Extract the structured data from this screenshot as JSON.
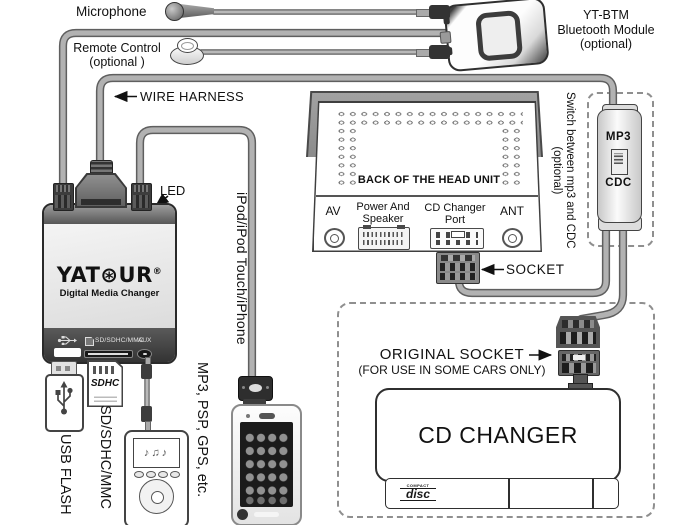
{
  "labels": {
    "microphone": "Microphone",
    "remote1": "Remote Control",
    "remote2": "(optional )",
    "wire_harness": "WIRE HARNESS",
    "btm1": "YT-BTM",
    "btm2": "Bluetooth Module",
    "btm3": "(optional)",
    "head_title": "BACK OF THE HEAD UNIT",
    "av": "AV",
    "power1": "Power And",
    "power2": "Speaker",
    "cdport1": "CD Changer",
    "cdport2": "Port",
    "ant": "ANT",
    "socket": "SOCKET",
    "switch_note1": "Switch between mp3 and CDC",
    "switch_note2": "(optional)",
    "switch_mp3": "MP3",
    "switch_cdc": "CDC",
    "orig1": "ORIGINAL SOCKET",
    "orig2": "(FOR USE IN SOME CARS ONLY)",
    "cd_changer": "CD CHANGER",
    "led": "LED",
    "v_ipod": "iPod/iPod Touch/iPhone",
    "v_mp3": "MP3, PSP, GPS, etc.",
    "v_usb": "USB FLASH",
    "v_sd": "SD/SDHC/MMC"
  },
  "yatour": {
    "brand_pre": "YAT",
    "brand_gear": "⊛",
    "brand_post": "UR",
    "registered": "®",
    "tagline": "Digital Media Changer",
    "ports_label": "SD/SDHC/MMC",
    "aux_label": "AUX"
  },
  "cd_logo": {
    "compact": "COMPACT",
    "disc": "disc"
  },
  "sd_card": {
    "logo": "SDHC"
  },
  "mp3_player": {
    "screen_notes": "♪♫♪"
  },
  "colors": {
    "background": "#ffffff",
    "line": "#333333",
    "cable_core": "#b2b2b2",
    "cable_edge": "#5f5f5f",
    "panel_gray": "#909090",
    "device_dark": "#4a4a4a"
  }
}
